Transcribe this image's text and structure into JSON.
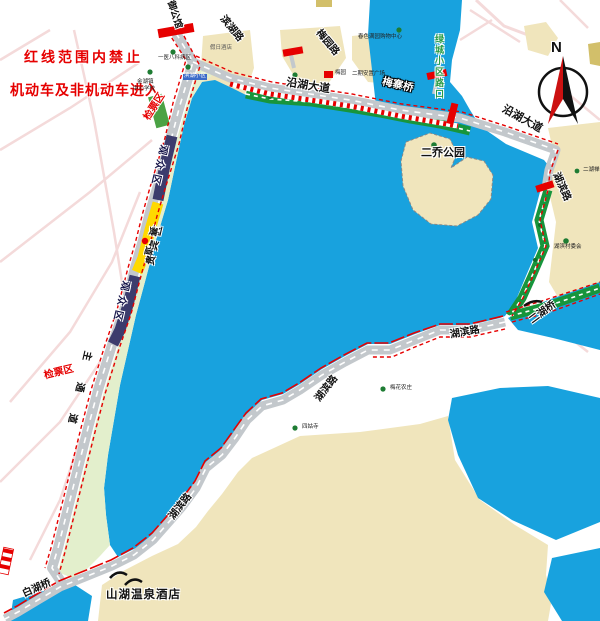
{
  "notice": {
    "line1": "红线范围内禁止",
    "line2": "机动车及非机动车进入"
  },
  "compass": {
    "north": "N"
  },
  "roads": {
    "yanhu_avenue_1": "沿湖大道",
    "yanhu_avenue_2": "沿湖大道",
    "hubin_road_right": "湖滨路",
    "hubin_road_mid": "湖滨路",
    "hubin_road_lower": "湖滨路",
    "hubin_road_bottom": "湖滨路",
    "gate_road": "御公馆",
    "binhu_road": "滨湖路",
    "meiyuan_road": "梅园路",
    "lvcheng_entrance": "绿城小区路口"
  },
  "bridges": {
    "meizhai": "梅寨桥",
    "erhu": "二湖桥",
    "baihu": "白湖桥"
  },
  "zones": {
    "ticket_check_1": "检票区",
    "ticket_check_2": "检票区",
    "spectator_1": "观众区",
    "spectator_2": "观众区",
    "vip": "贵宾区",
    "track": "赛道",
    "main_channel": "主通道"
  },
  "places": {
    "erqiao_park": "二乔公园",
    "hotel": "山湖温泉酒店",
    "hospital": "一医八科病区",
    "community": "滨湖小区",
    "school_line1": "金湖镇",
    "school_line2": "中心学校",
    "holiday_hotel": "假日酒店",
    "mall": "春色满园购物中心",
    "meiyuan": "梅园",
    "plaza": "二期安置广场",
    "village": "湖滨村委会",
    "temple_right": "二湖禅寺",
    "farm": "梅花农庄",
    "temple_south": "四姑寺"
  },
  "colors": {
    "red_line": "#e60000",
    "lake": "#18a2de",
    "track_green": "#17953c",
    "vip_yellow": "#ffd900",
    "spectator_navy": "#3c3c6d",
    "land": "#f0e5bc",
    "road": "#c3c8cc"
  }
}
